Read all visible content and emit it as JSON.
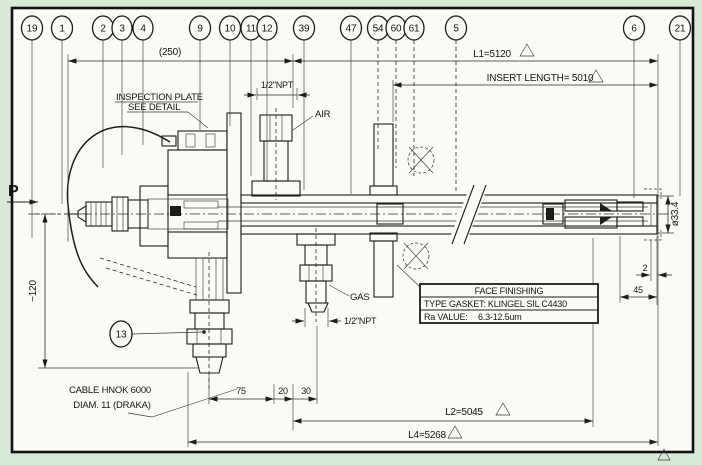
{
  "balloons": {
    "b19": "19",
    "b1": "1",
    "b2": "2",
    "b3": "3",
    "b4": "4",
    "b9": "9",
    "b10": "10",
    "b11": "11",
    "b12": "12",
    "b39": "39",
    "b47": "47",
    "b54": "54",
    "b60": "60",
    "b61": "61",
    "b5": "5",
    "b6": "6",
    "b21": "21",
    "b13": "13"
  },
  "dimensions": {
    "overall": "(250)",
    "l1": "L1=5120",
    "insert": "INSERT LENGTH= 5010",
    "l2": "L2=5045",
    "l4": "L4=5268",
    "npt_air": "1/2\"NPT",
    "npt_gas": "1/2\"NPT",
    "dia": "ø33.4",
    "two": "2",
    "fortyfive": "45",
    "seventyfive": "75",
    "twenty": "20",
    "thirty": "30",
    "v120": "~120"
  },
  "labels": {
    "pressure": "P",
    "air": "AIR",
    "gas": "GAS",
    "inspection1": "INSPECTION PLATE",
    "inspection2": "SEE DETAIL",
    "cable1": "CABLE HNOK 6000",
    "cable2": "DIAM. 11 (DRAKA)"
  },
  "table": {
    "title": "FACE FINISHING",
    "row1": "TYPE GASKET: KLINGEL SIL C4430",
    "row2_label": "Ra VALUE:",
    "row2_value": "6.3-12.5um"
  },
  "colors": {
    "paper": "#fbfbf6",
    "margin": "#d7ead5",
    "ink": "#1c1c1c"
  }
}
